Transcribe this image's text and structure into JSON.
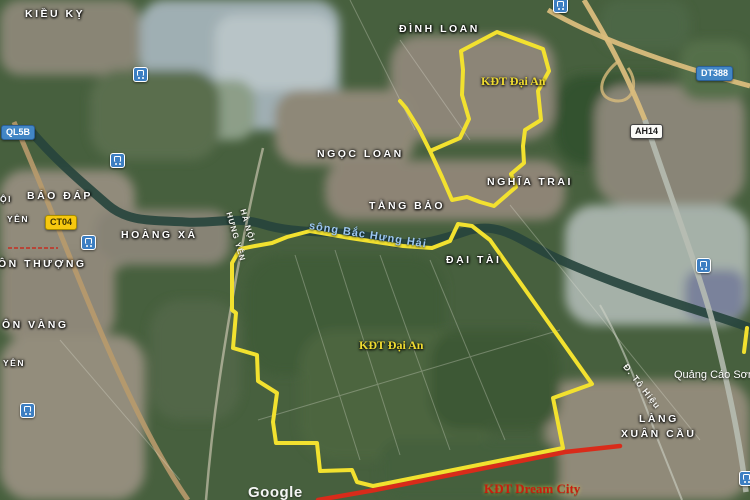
{
  "map": {
    "attribution": "Google",
    "labels": [
      {
        "name": "label-kieu-ky",
        "text": "KIỀU KỴ",
        "x": 25,
        "y": 8,
        "cls": "place"
      },
      {
        "name": "label-dinh-loan",
        "text": "ĐÌNH LOAN",
        "x": 399,
        "y": 23,
        "cls": "place"
      },
      {
        "name": "label-ngoc-loan",
        "text": "NGỌC LOAN",
        "x": 317,
        "y": 148,
        "cls": "place"
      },
      {
        "name": "label-nghia-trai",
        "text": "NGHĨA TRAI",
        "x": 487,
        "y": 176,
        "cls": "place"
      },
      {
        "name": "label-bao-dap",
        "text": "BÁO ĐÁP",
        "x": 27,
        "y": 190,
        "cls": "place"
      },
      {
        "name": "label-hoang-xa",
        "text": "HOÀNG XÁ",
        "x": 121,
        "y": 229,
        "cls": "place"
      },
      {
        "name": "label-tang-bao",
        "text": "TẰNG BẢO",
        "x": 369,
        "y": 200,
        "cls": "place"
      },
      {
        "name": "label-dai-tai",
        "text": "ĐẠI TÀI",
        "x": 446,
        "y": 254,
        "cls": "place"
      },
      {
        "name": "label-thon-thuong",
        "text": "ÔN THƯỢNG",
        "x": -2,
        "y": 258,
        "cls": "place"
      },
      {
        "name": "label-thon-vang",
        "text": "ÔN VÀNG",
        "x": 2,
        "y": 319,
        "cls": "place"
      },
      {
        "name": "label-lang",
        "text": "LÀNG",
        "x": 639,
        "y": 413,
        "cls": "place"
      },
      {
        "name": "label-xuan-cau",
        "text": "XUÂN CẦU",
        "x": 621,
        "y": 428,
        "cls": "place"
      },
      {
        "name": "label-oi",
        "text": "ỘI",
        "x": 0,
        "y": 194,
        "cls": "place sm"
      },
      {
        "name": "label-yen-1",
        "text": "YÊN",
        "x": 7,
        "y": 214,
        "cls": "place sm"
      },
      {
        "name": "label-yen-2",
        "text": "YÊN",
        "x": 3,
        "y": 358,
        "cls": "place sm"
      },
      {
        "name": "label-ha-noi-road",
        "text": "HÀ NỘI",
        "x": 247,
        "y": 208,
        "cls": "roadlbl",
        "rot": 74
      },
      {
        "name": "label-hung-yen-road",
        "text": "HƯNG YÊN",
        "x": 233,
        "y": 211,
        "cls": "roadlbl",
        "rot": 74
      },
      {
        "name": "label-to-hieu-road",
        "text": "Đ. Tô Hiệu",
        "x": 629,
        "y": 362,
        "cls": "roadlbl",
        "rot": 52,
        "size": 9
      },
      {
        "name": "label-river",
        "text": "sông Bắc Hưng Hải",
        "x": 310,
        "y": 220,
        "cls": "water",
        "rot": 9
      },
      {
        "name": "label-kdt-dai-an-north",
        "text": "KĐT Đại An",
        "x": 481,
        "y": 74,
        "cls": "area"
      },
      {
        "name": "label-kdt-dai-an-south",
        "text": "KĐT Đại An",
        "x": 359,
        "y": 338,
        "cls": "area"
      },
      {
        "name": "label-kdt-dream-city",
        "text": "KĐT Dream City",
        "x": 484,
        "y": 481,
        "cls": "dream"
      },
      {
        "name": "label-quang-cao-son",
        "text": "Quảng Cáo Sơn",
        "x": 674,
        "y": 369,
        "cls": "poiname"
      },
      {
        "name": "google-watermark",
        "text": "Google",
        "x": 248,
        "y": 484,
        "cls": "watermark"
      }
    ],
    "shields": [
      {
        "name": "shield-ql5b",
        "text": "QL5B",
        "x": 1,
        "y": 125,
        "style": "blue"
      },
      {
        "name": "shield-ct04",
        "text": "CT04",
        "x": 45,
        "y": 215,
        "style": "yellow"
      },
      {
        "name": "shield-dt388",
        "text": "DT388",
        "x": 696,
        "y": 66,
        "style": "blue"
      },
      {
        "name": "shield-ah14",
        "text": "AH14",
        "x": 630,
        "y": 124,
        "style": "white"
      }
    ],
    "poi_icons": [
      {
        "name": "transit-icon-1",
        "x": 140,
        "y": 74
      },
      {
        "name": "transit-icon-2",
        "x": 117,
        "y": 160
      },
      {
        "name": "transit-icon-3",
        "x": 88,
        "y": 242
      },
      {
        "name": "transit-icon-4",
        "x": 560,
        "y": 5
      },
      {
        "name": "transit-icon-5",
        "x": 703,
        "y": 265
      },
      {
        "name": "transit-icon-6",
        "x": 27,
        "y": 410
      },
      {
        "name": "transit-icon-7",
        "x": 746,
        "y": 478
      }
    ],
    "overlays": {
      "boundary_color": "#f2e12f",
      "boundary_paths": [
        "M 400,101 L 406,108 L 419,129 L 430,151 L 460,138 L 469,119 L 462,95 L 463,70 L 461,51 L 497,32 L 543,49 L 549,71 L 538,91 L 541,120 L 525,130 L 523,146 L 524,163 L 511,174 L 516,187 L 494,206 L 480,202 L 467,197 L 452,200 L 442,177 L 430,151",
        "M 287,237 L 310,231 L 350,238 L 403,246 L 432,248 L 450,241 L 458,224 L 472,226 L 490,240 L 592,384 L 553,398 L 563,448 L 373,486 L 357,482 L 352,470 L 320,471 L 317,443 L 276,443 L 273,422 L 277,393 L 258,381 L 257,355 L 233,348 L 236,313 L 232,310 L 232,263 L 240,249 L 255,246 L 272,243 Z",
        "M 747,328 L 744,352"
      ],
      "road_line_color": "#d92b1a",
      "road_line_path": "M 318,500 L 375,490 L 565,452 L 620,446"
    }
  }
}
